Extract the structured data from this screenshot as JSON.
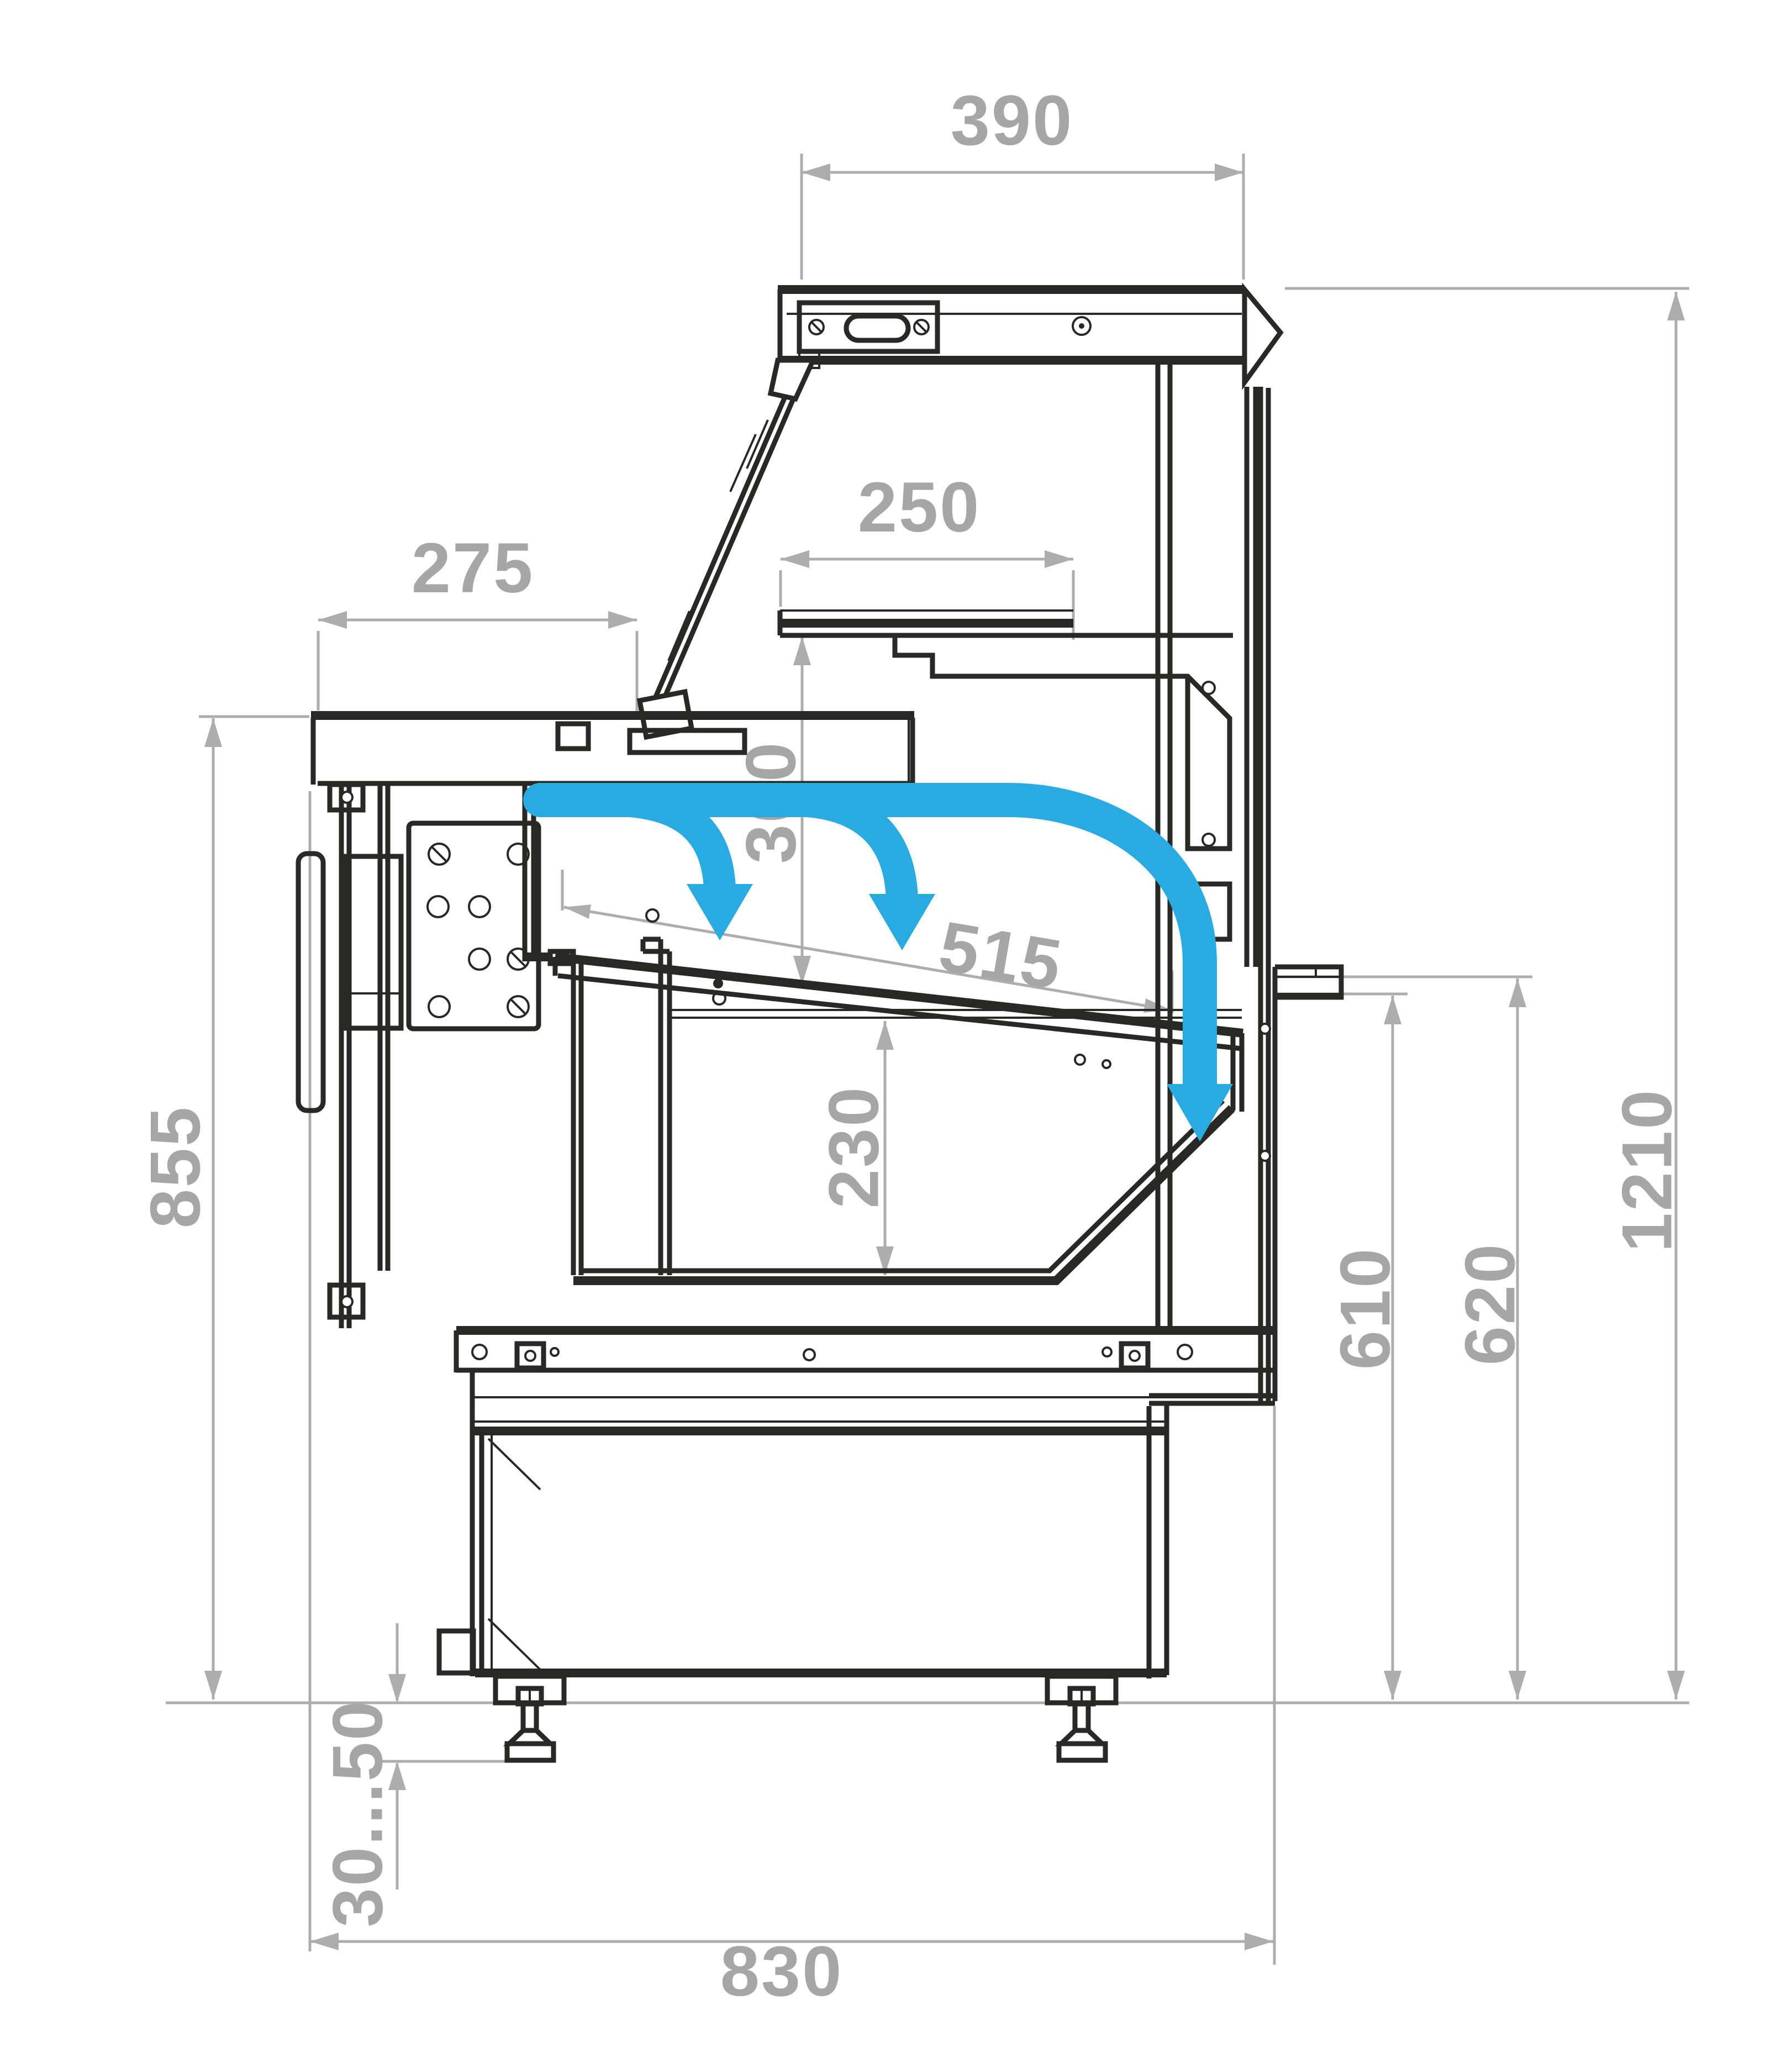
{
  "drawing": {
    "type": "technical-dimension-drawing",
    "view": "side-cross-section",
    "subject": "refrigerated serve-over display counter",
    "units": "mm",
    "dims": {
      "canopy_depth": "390",
      "shelf_depth": "250",
      "counter_depth": "275",
      "shelf_clearance": "300",
      "display_deck_depth": "515",
      "well_depth": "230",
      "counter_height": "855",
      "rear_inner_height": "610",
      "rear_outer_height": "620",
      "overall_height": "1210",
      "leg_adjust_range": "30...50",
      "overall_depth": "830"
    },
    "airflow": {
      "arrow_count": 3,
      "description": "cold air curtain arrows over display deck"
    },
    "colors": {
      "outline": "#2a2825",
      "dimension_gray": "#adadad",
      "label_gray": "#a6a6a6",
      "airflow_blue": "#29abe2",
      "background": "#ffffff"
    }
  }
}
